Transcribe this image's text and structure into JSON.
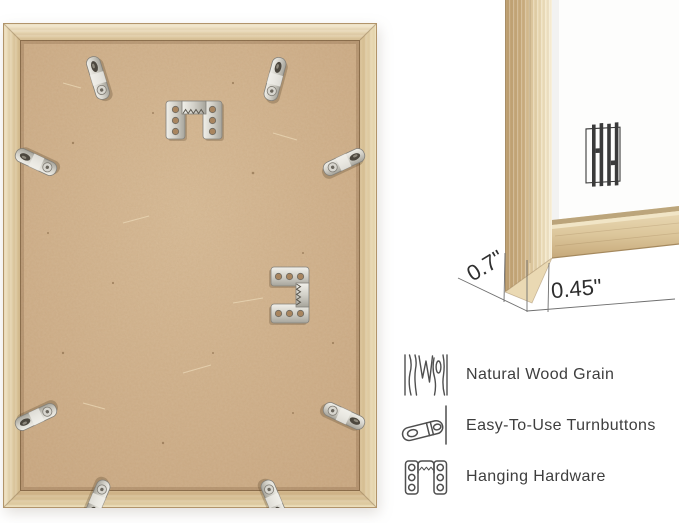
{
  "colors": {
    "background": "#ffffff",
    "frame_wood": "#dfc8a0",
    "backing_board": "#c9a67f",
    "hardware_metal": "#d6d4cd",
    "text_ink": "#3e3e3e",
    "logo_ink": "#3a3a3a"
  },
  "corner_detail": {
    "depth_label": "0.7\"",
    "face_label": "0.45\"",
    "logo": "brand-monogram-hh"
  },
  "features": {
    "items": [
      {
        "icon": "wood-grain-icon",
        "label": "Natural Wood Grain"
      },
      {
        "icon": "turnbutton-icon",
        "label": "Easy-To-Use Turnbuttons"
      },
      {
        "icon": "hanging-hardware-icon",
        "label": "Hanging Hardware"
      }
    ]
  }
}
